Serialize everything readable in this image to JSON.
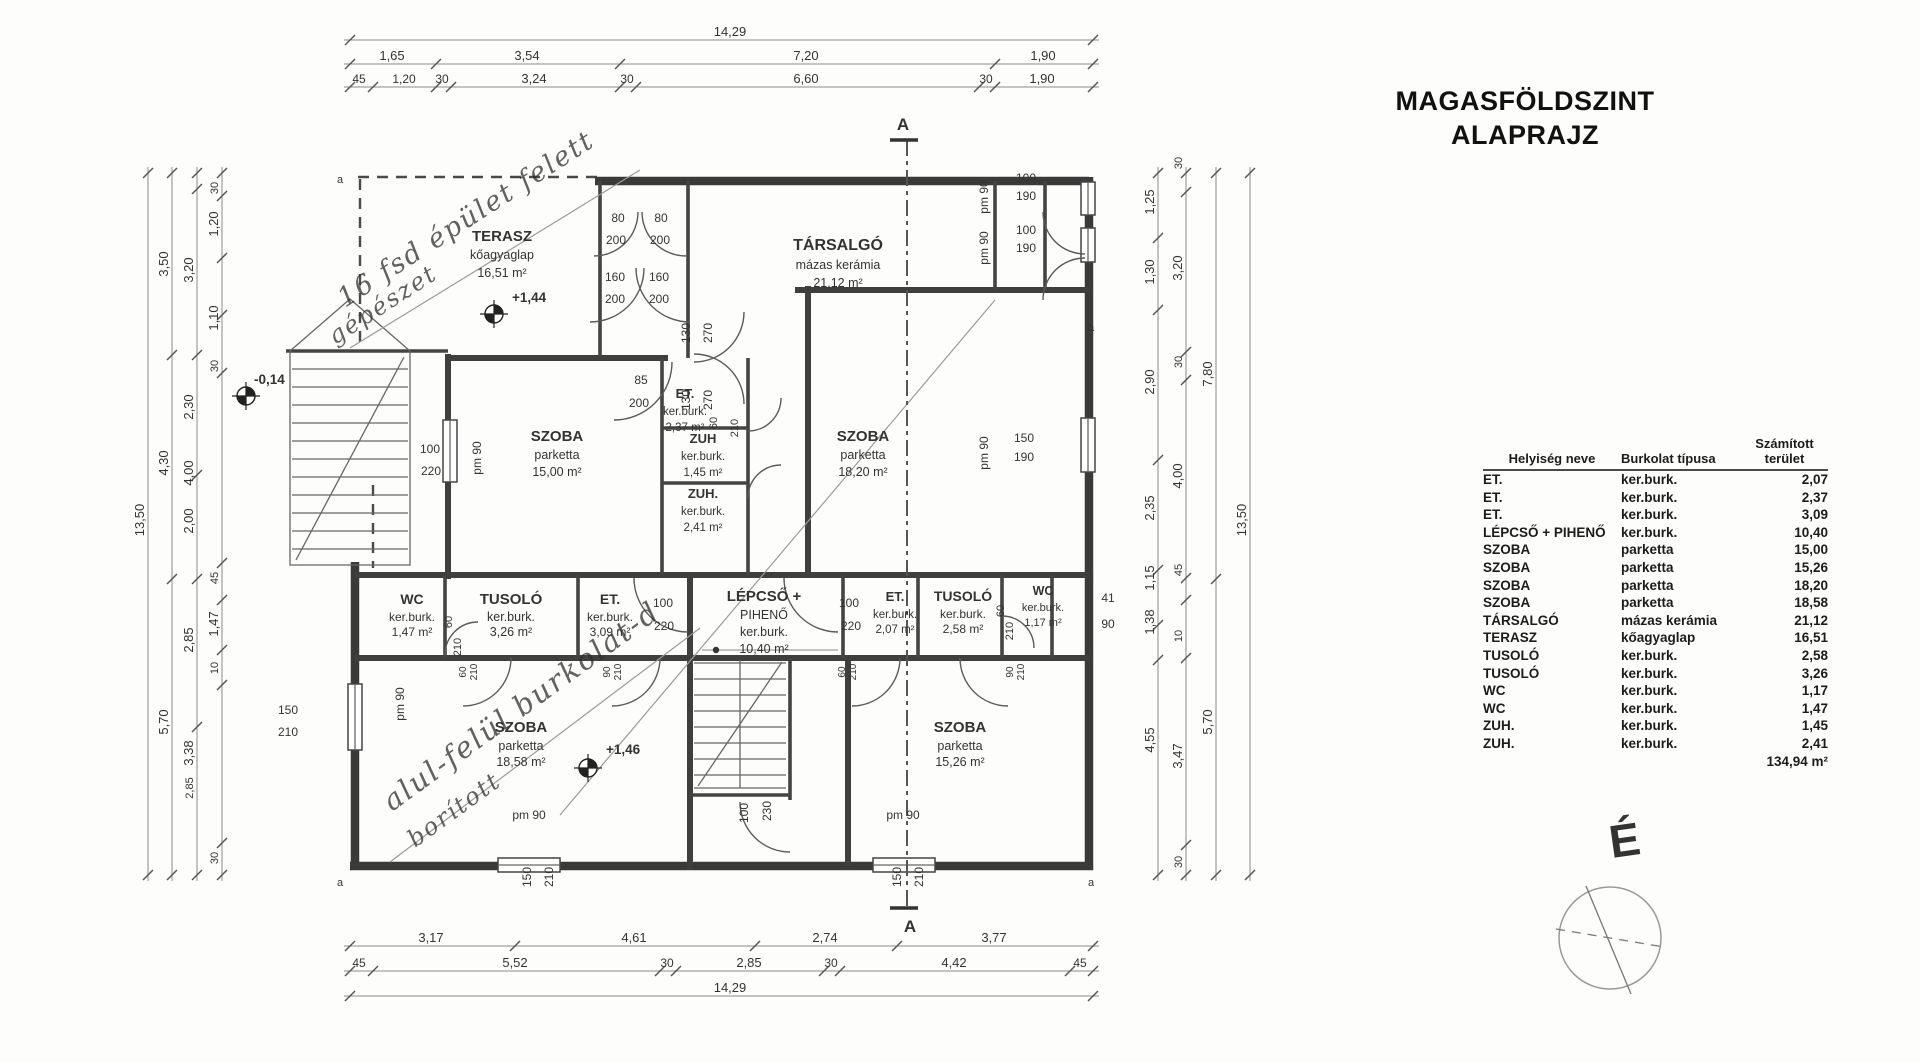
{
  "title": {
    "line1": "MAGASFÖLDSZINT",
    "line2": "ALAPRAJZ"
  },
  "compass": {
    "label": "É"
  },
  "table": {
    "headers": [
      "Helyiség neve",
      "Burkolat típusa",
      "Számított\nterület"
    ],
    "rows": [
      {
        "name": "ET.",
        "finish": "ker.burk.",
        "area": "2,07"
      },
      {
        "name": "ET.",
        "finish": "ker.burk.",
        "area": "2,37"
      },
      {
        "name": "ET.",
        "finish": "ker.burk.",
        "area": "3,09"
      },
      {
        "name": "LÉPCSŐ + PIHENŐ",
        "finish": "ker.burk.",
        "area": "10,40"
      },
      {
        "name": "SZOBA",
        "finish": "parketta",
        "area": "15,00"
      },
      {
        "name": "SZOBA",
        "finish": "parketta",
        "area": "15,26"
      },
      {
        "name": "SZOBA",
        "finish": "parketta",
        "area": "18,20"
      },
      {
        "name": "SZOBA",
        "finish": "parketta",
        "area": "18,58"
      },
      {
        "name": "TÁRSALGÓ",
        "finish": "mázas kerámia",
        "area": "21,12"
      },
      {
        "name": "TERASZ",
        "finish": "kőagyaglap",
        "area": "16,51"
      },
      {
        "name": "TUSOLÓ",
        "finish": "ker.burk.",
        "area": "2,58"
      },
      {
        "name": "TUSOLÓ",
        "finish": "ker.burk.",
        "area": "3,26"
      },
      {
        "name": "WC",
        "finish": "ker.burk.",
        "area": "1,17"
      },
      {
        "name": "WC",
        "finish": "ker.burk.",
        "area": "1,47"
      },
      {
        "name": "ZUH.",
        "finish": "ker.burk.",
        "area": "1,45"
      },
      {
        "name": "ZUH.",
        "finish": "ker.burk.",
        "area": "2,41"
      }
    ],
    "total": "134,94 m²"
  },
  "plan": {
    "section": {
      "label": "A"
    },
    "rooms": [
      {
        "name": "terasz",
        "x": 502,
        "ys": [
          241,
          259,
          277
        ],
        "lines": [
          "TERASZ",
          "kőagyaglap",
          "16,51 m²"
        ]
      },
      {
        "name": "tarsalgo",
        "x": 838,
        "ys": [
          250,
          269,
          287
        ],
        "lines": [
          "TÁRSALGÓ",
          "mázas kerámia",
          "21,12 m²"
        ],
        "ts": 16
      },
      {
        "name": "szoba-15-00",
        "x": 557,
        "ys": [
          441,
          459,
          476
        ],
        "lines": [
          "SZOBA",
          "parketta",
          "15,00 m²"
        ]
      },
      {
        "name": "szoba-18-20",
        "x": 863,
        "ys": [
          441,
          459,
          476
        ],
        "lines": [
          "SZOBA",
          "parketta",
          "18,20 m²"
        ]
      },
      {
        "name": "et-2-37",
        "x": 685,
        "ys": [
          398,
          415,
          431
        ],
        "lines": [
          "ET.",
          "ker.burk.",
          "2,37 m²"
        ],
        "ts": 13,
        "ss": 11.5
      },
      {
        "name": "zuh-1-45",
        "x": 703,
        "ys": [
          443,
          460,
          476
        ],
        "lines": [
          "ZUH",
          "ker.burk.",
          "1,45 m²"
        ],
        "ts": 13,
        "ss": 11.5
      },
      {
        "name": "zuh-2-41",
        "x": 703,
        "ys": [
          498,
          515,
          531
        ],
        "lines": [
          "ZUH.",
          "ker.burk.",
          "2,41 m²"
        ],
        "ts": 13,
        "ss": 11.5
      },
      {
        "name": "wc-1-47",
        "x": 412,
        "ys": [
          604,
          621,
          636
        ],
        "lines": [
          "WC",
          "ker.burk.",
          "1,47 m²"
        ],
        "ts": 14,
        "ss": 12
      },
      {
        "name": "tusolo-3-26",
        "x": 511,
        "ys": [
          604,
          621,
          636
        ],
        "lines": [
          "TUSOLÓ",
          "ker.burk.",
          "3,26 m²"
        ]
      },
      {
        "name": "et-3-09",
        "x": 610,
        "ys": [
          604,
          621,
          636
        ],
        "lines": [
          "ET.",
          "ker.burk.",
          "3,09 m²"
        ],
        "ts": 14,
        "ss": 12
      },
      {
        "name": "lepcso-piheno",
        "x": 764,
        "ys": [
          601,
          619,
          636,
          653
        ],
        "lines": [
          "LÉPCSŐ +",
          "PIHENŐ",
          "ker.burk.",
          "10,40 m²"
        ]
      },
      {
        "name": "et-2-07",
        "x": 895,
        "ys": [
          601,
          618,
          633
        ],
        "lines": [
          "ET.",
          "ker.burk.",
          "2,07 m²"
        ],
        "ts": 13,
        "ss": 11.5
      },
      {
        "name": "tusolo-2-58",
        "x": 963,
        "ys": [
          601,
          618,
          633
        ],
        "lines": [
          "TUSOLÓ",
          "ker.burk.",
          "2,58 m²"
        ],
        "ts": 14,
        "ss": 12
      },
      {
        "name": "wc-1-17",
        "x": 1043,
        "ys": [
          595,
          611,
          626
        ],
        "lines": [
          "WC",
          "ker.burk.",
          "1,17 m²"
        ],
        "ts": 12.5,
        "ss": 11
      },
      {
        "name": "szoba-18-58",
        "x": 521,
        "ys": [
          732,
          750,
          766
        ],
        "lines": [
          "SZOBA",
          "parketta",
          "18,58 m²"
        ]
      },
      {
        "name": "szoba-15-26",
        "x": 960,
        "ys": [
          732,
          750,
          766
        ],
        "lines": [
          "SZOBA",
          "parketta",
          "15,26 m²"
        ]
      }
    ],
    "level_markers": [
      {
        "label": "+1,44",
        "x": 494,
        "y": 314,
        "lx": 512,
        "ly": 302
      },
      {
        "label": "+1,46",
        "x": 588,
        "y": 768,
        "lx": 606,
        "ly": 754
      },
      {
        "label": "-0,14",
        "x": 246,
        "y": 396,
        "lx": 254,
        "ly": 384
      }
    ],
    "annotations": [
      {
        "t": "16 fsd épület felett",
        "x": 345,
        "y": 308,
        "r": -33,
        "s": 27
      },
      {
        "t": "gépészet",
        "x": 335,
        "y": 345,
        "r": -33,
        "s": 24
      },
      {
        "t": "alul-felül burkolat-d",
        "x": 392,
        "y": 812,
        "r": -36,
        "s": 29
      },
      {
        "t": "borított",
        "x": 415,
        "y": 848,
        "r": -36,
        "s": 24
      }
    ],
    "labels": [
      {
        "t": "80",
        "x": 618,
        "y": 222
      },
      {
        "t": "80",
        "x": 661,
        "y": 222
      },
      {
        "t": "200",
        "x": 616,
        "y": 244
      },
      {
        "t": "200",
        "x": 660,
        "y": 244
      },
      {
        "t": "160",
        "x": 615,
        "y": 281
      },
      {
        "t": "160",
        "x": 659,
        "y": 281
      },
      {
        "t": "200",
        "x": 615,
        "y": 303
      },
      {
        "t": "200",
        "x": 659,
        "y": 303
      },
      {
        "t": "85",
        "x": 641,
        "y": 384
      },
      {
        "t": "200",
        "x": 639,
        "y": 407
      },
      {
        "t": "130",
        "x": 690,
        "y": 333,
        "r": -90
      },
      {
        "t": "270",
        "x": 712,
        "y": 333,
        "r": -90
      },
      {
        "t": "130",
        "x": 690,
        "y": 400,
        "r": -90
      },
      {
        "t": "270",
        "x": 712,
        "y": 400,
        "r": -90
      },
      {
        "t": "60",
        "x": 717,
        "y": 423,
        "r": -90,
        "s": 11
      },
      {
        "t": "210",
        "x": 738,
        "y": 428,
        "r": -90,
        "s": 11
      },
      {
        "t": "100",
        "x": 663,
        "y": 607
      },
      {
        "t": "220",
        "x": 664,
        "y": 630
      },
      {
        "t": "100",
        "x": 849,
        "y": 607
      },
      {
        "t": "220",
        "x": 851,
        "y": 630
      },
      {
        "t": "60",
        "x": 452,
        "y": 622,
        "r": -90,
        "s": 11
      },
      {
        "t": "210",
        "x": 461,
        "y": 647,
        "r": -90,
        "s": 11
      },
      {
        "t": "60",
        "x": 1004,
        "y": 611,
        "r": -90,
        "s": 11
      },
      {
        "t": "210",
        "x": 1013,
        "y": 631,
        "r": -90,
        "s": 11
      },
      {
        "t": "100",
        "x": 748,
        "y": 813,
        "r": -90
      },
      {
        "t": "230",
        "x": 771,
        "y": 811,
        "r": -90
      },
      {
        "t": "150",
        "x": 531,
        "y": 877,
        "r": -90
      },
      {
        "t": "210",
        "x": 553,
        "y": 877,
        "r": -90
      },
      {
        "t": "150",
        "x": 901,
        "y": 877,
        "r": -90
      },
      {
        "t": "210",
        "x": 923,
        "y": 877,
        "r": -90
      },
      {
        "t": "150",
        "x": 288,
        "y": 714
      },
      {
        "t": "210",
        "x": 288,
        "y": 736
      },
      {
        "t": "100",
        "x": 430,
        "y": 453
      },
      {
        "t": "220",
        "x": 431,
        "y": 475
      },
      {
        "t": "100",
        "x": 1026,
        "y": 182
      },
      {
        "t": "190",
        "x": 1026,
        "y": 200
      },
      {
        "t": "100",
        "x": 1026,
        "y": 234
      },
      {
        "t": "190",
        "x": 1026,
        "y": 252
      },
      {
        "t": "150",
        "x": 1024,
        "y": 442
      },
      {
        "t": "190",
        "x": 1024,
        "y": 461
      },
      {
        "t": "41",
        "x": 1108,
        "y": 602
      },
      {
        "t": "90",
        "x": 1108,
        "y": 628
      },
      {
        "t": "pm 90",
        "x": 481,
        "y": 458,
        "r": -90
      },
      {
        "t": "pm 90",
        "x": 988,
        "y": 197,
        "r": -90
      },
      {
        "t": "pm 90",
        "x": 988,
        "y": 248,
        "r": -90
      },
      {
        "t": "pm 90",
        "x": 988,
        "y": 453,
        "r": -90
      },
      {
        "t": "pm 90",
        "x": 404,
        "y": 704,
        "r": -90
      },
      {
        "t": "pm 90",
        "x": 529,
        "y": 819
      },
      {
        "t": "pm 90",
        "x": 903,
        "y": 819
      },
      {
        "t": "a",
        "x": 340,
        "y": 183,
        "s": 11
      },
      {
        "t": "a",
        "x": 1091,
        "y": 331,
        "s": 11
      },
      {
        "t": "a",
        "x": 340,
        "y": 886,
        "s": 11
      },
      {
        "t": "a",
        "x": 1091,
        "y": 886,
        "s": 11
      },
      {
        "t": "60",
        "x": 466,
        "y": 672,
        "r": -90,
        "s": 10
      },
      {
        "t": "210",
        "x": 477,
        "y": 672,
        "r": -90,
        "s": 10
      },
      {
        "t": "90",
        "x": 610,
        "y": 672,
        "r": -90,
        "s": 10
      },
      {
        "t": "210",
        "x": 621,
        "y": 672,
        "r": -90,
        "s": 10
      },
      {
        "t": "60",
        "x": 845,
        "y": 672,
        "r": -90,
        "s": 10
      },
      {
        "t": "210",
        "x": 856,
        "y": 672,
        "r": -90,
        "s": 10
      },
      {
        "t": "90",
        "x": 1013,
        "y": 672,
        "r": -90,
        "s": 10
      },
      {
        "t": "210",
        "x": 1024,
        "y": 672,
        "r": -90,
        "s": 10
      }
    ],
    "dims_h": [
      {
        "y": 40,
        "x1": 344,
        "x2": 1099,
        "ticks": [
          350,
          1093
        ],
        "labels": [
          {
            "t": "14,29",
            "x": 730
          }
        ]
      },
      {
        "y": 64,
        "x1": 344,
        "x2": 1099,
        "ticks": [
          350,
          436,
          620,
          995,
          1093
        ],
        "labels": [
          {
            "t": "1,65",
            "x": 392
          },
          {
            "t": "3,54",
            "x": 527
          },
          {
            "t": "7,20",
            "x": 806
          },
          {
            "t": "1,90",
            "x": 1043
          }
        ]
      },
      {
        "y": 87,
        "x1": 344,
        "x2": 1099,
        "ticks": [
          350,
          373,
          436,
          451,
          620,
          636,
          979,
          995,
          1093
        ],
        "labels": [
          {
            "t": "45",
            "x": 359,
            "s": 12
          },
          {
            "t": "1,20",
            "x": 404,
            "s": 12
          },
          {
            "t": "30",
            "x": 442,
            "s": 12
          },
          {
            "t": "3,24",
            "x": 534
          },
          {
            "t": "30",
            "x": 627,
            "s": 12
          },
          {
            "t": "6,60",
            "x": 806
          },
          {
            "t": "30",
            "x": 986,
            "s": 12
          },
          {
            "t": "1,90",
            "x": 1042
          }
        ]
      },
      {
        "y": 946,
        "x1": 344,
        "x2": 1099,
        "ticks": [
          350,
          515,
          755,
          897,
          1093
        ],
        "labels": [
          {
            "t": "3,17",
            "x": 431
          },
          {
            "t": "4,61",
            "x": 634
          },
          {
            "t": "2,74",
            "x": 825
          },
          {
            "t": "3,77",
            "x": 994
          }
        ]
      },
      {
        "y": 971,
        "x1": 344,
        "x2": 1099,
        "ticks": [
          350,
          373,
          660,
          676,
          824,
          840,
          1070,
          1093
        ],
        "labels": [
          {
            "t": "45",
            "x": 359,
            "s": 12
          },
          {
            "t": "5,52",
            "x": 515
          },
          {
            "t": "30",
            "x": 667,
            "s": 12
          },
          {
            "t": "2,85",
            "x": 749
          },
          {
            "t": "30",
            "x": 831,
            "s": 12
          },
          {
            "t": "4,42",
            "x": 954
          },
          {
            "t": "45",
            "x": 1080,
            "s": 12
          }
        ]
      },
      {
        "y": 996,
        "x1": 344,
        "x2": 1099,
        "ticks": [
          350,
          1093
        ],
        "labels": [
          {
            "t": "14,29",
            "x": 730
          }
        ]
      }
    ],
    "dims_v": [
      {
        "x": 148,
        "y1": 167,
        "y2": 881,
        "ticks": [
          173,
          875
        ],
        "labels": [
          {
            "t": "13,50",
            "y": 520
          }
        ]
      },
      {
        "x": 172,
        "y1": 167,
        "y2": 881,
        "ticks": [
          173,
          355,
          579,
          875
        ],
        "labels": [
          {
            "t": "3,50",
            "y": 264
          },
          {
            "t": "4,30",
            "y": 463
          },
          {
            "t": "5,70",
            "y": 722
          }
        ]
      },
      {
        "x": 197,
        "y1": 167,
        "y2": 881,
        "ticks": [
          173,
          189,
          355,
          475,
          579,
          727,
          875
        ],
        "labels": [
          {
            "t": "3,20",
            "y": 270
          },
          {
            "t": "2,30",
            "y": 407
          },
          {
            "t": "4,00",
            "y": 473
          },
          {
            "t": "2,00",
            "y": 521
          },
          {
            "t": "2,85",
            "y": 640
          },
          {
            "t": "3,38",
            "y": 753
          },
          {
            "t": "2,85",
            "y": 788,
            "s": 11
          }
        ]
      },
      {
        "x": 222,
        "y1": 167,
        "y2": 881,
        "ticks": [
          173,
          196,
          258,
          315,
          373,
          563,
          600,
          650,
          685,
          843,
          875
        ],
        "labels": [
          {
            "t": "30",
            "y": 188,
            "s": 11
          },
          {
            "t": "1,20",
            "y": 224
          },
          {
            "t": "1,10",
            "y": 318
          },
          {
            "t": "30",
            "y": 366,
            "s": 11
          },
          {
            "t": "45",
            "y": 578,
            "s": 11
          },
          {
            "t": "1,47",
            "y": 624
          },
          {
            "t": "10",
            "y": 668,
            "s": 11
          },
          {
            "t": "30",
            "y": 858,
            "s": 11
          }
        ]
      },
      {
        "x": 1158,
        "y1": 167,
        "y2": 881,
        "ticks": [
          173,
          238,
          310,
          460,
          570,
          625,
          660,
          875
        ],
        "labels": [
          {
            "t": "1,25",
            "y": 202
          },
          {
            "t": "1,30",
            "y": 272
          },
          {
            "t": "2,90",
            "y": 382
          },
          {
            "t": "2,35",
            "y": 508
          },
          {
            "t": "1,15",
            "y": 578
          },
          {
            "t": "1,38",
            "y": 622
          },
          {
            "t": "4,55",
            "y": 740
          }
        ]
      },
      {
        "x": 1186,
        "y1": 167,
        "y2": 881,
        "ticks": [
          173,
          192,
          352,
          380,
          578,
          600,
          658,
          845,
          875
        ],
        "labels": [
          {
            "t": "30",
            "y": 163,
            "s": 11
          },
          {
            "t": "3,20",
            "y": 268
          },
          {
            "t": "30",
            "y": 362,
            "s": 11
          },
          {
            "t": "4,00",
            "y": 476
          },
          {
            "t": "45",
            "y": 570,
            "s": 11
          },
          {
            "t": "10",
            "y": 636,
            "s": 11
          },
          {
            "t": "3,47",
            "y": 756
          },
          {
            "t": "30",
            "y": 862,
            "s": 11
          }
        ]
      },
      {
        "x": 1216,
        "y1": 167,
        "y2": 881,
        "ticks": [
          173,
          579,
          875
        ],
        "labels": [
          {
            "t": "7,80",
            "y": 374
          },
          {
            "t": "5,70",
            "y": 722
          }
        ]
      },
      {
        "x": 1250,
        "y1": 167,
        "y2": 881,
        "ticks": [
          173,
          875
        ],
        "labels": [
          {
            "t": "13,50",
            "y": 520
          }
        ]
      }
    ]
  }
}
